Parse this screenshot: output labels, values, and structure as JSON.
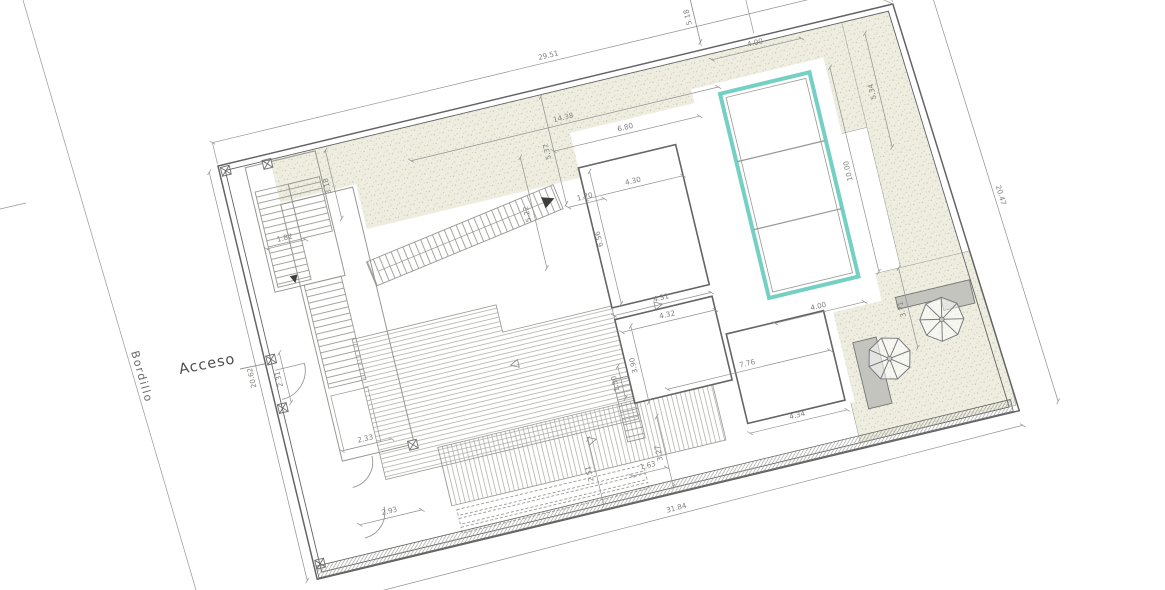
{
  "drawing": {
    "labels": {
      "acceso": "Acceso",
      "bordillo": "Bordillo"
    },
    "colors": {
      "pool": "#74d0c3",
      "garden_fill": "#eeede0",
      "speckle": "#c8c7b1",
      "line": "#979792",
      "wall": "#646464",
      "dim": "#8f8f8f",
      "text": "#81817d",
      "platform": "#c4c4bf"
    },
    "dimensions": [
      {
        "value": "29.51",
        "x1": 0,
        "y1": -24,
        "x2": 694,
        "y2": -24
      },
      {
        "value": "3.58",
        "x1": 552,
        "y1": -46,
        "x2": 634,
        "y2": -46
      },
      {
        "value": "5.34",
        "x1": 660,
        "y1": 22,
        "x2": 660,
        "y2": 139
      },
      {
        "value": "5.18",
        "x1": 498,
        "y1": -62,
        "x2": 498,
        "y2": -8
      },
      {
        "value": "4.00",
        "x1": 505,
        "y1": 12,
        "x2": 597,
        "y2": 12
      },
      {
        "value": "14.38",
        "x1": 189,
        "y1": 40,
        "x2": 505,
        "y2": 40
      },
      {
        "value": "6.80",
        "x1": 330,
        "y1": 64,
        "x2": 480,
        "y2": 64
      },
      {
        "value": "5.37",
        "x1": 330,
        "y1": 8,
        "x2": 330,
        "y2": 118
      },
      {
        "value": "5.22",
        "x1": 296,
        "y1": 62,
        "x2": 296,
        "y2": 176
      },
      {
        "value": "3.18",
        "x1": 108,
        "y1": 10,
        "x2": 108,
        "y2": 80
      },
      {
        "value": "1.82",
        "x1": 28,
        "y1": 92,
        "x2": 68,
        "y2": 92
      },
      {
        "value": "1.70",
        "x1": 331,
        "y1": 122,
        "x2": 368,
        "y2": 122
      },
      {
        "value": "4.30",
        "x1": 350,
        "y1": 118,
        "x2": 450,
        "y2": 118
      },
      {
        "value": "6.56",
        "x1": 360,
        "y1": 92,
        "x2": 360,
        "y2": 228
      },
      {
        "value": "4.31",
        "x1": 350,
        "y1": 238,
        "x2": 450,
        "y2": 238
      },
      {
        "value": "4.32",
        "x1": 354,
        "y1": 256,
        "x2": 450,
        "y2": 256
      },
      {
        "value": "3.90",
        "x1": 364,
        "y1": 252,
        "x2": 364,
        "y2": 330
      },
      {
        "value": "1.50",
        "x1": 342,
        "y1": 288,
        "x2": 342,
        "y2": 321
      },
      {
        "value": "7.76",
        "x1": 385,
        "y1": 322,
        "x2": 552,
        "y2": 322
      },
      {
        "value": "4.34",
        "x1": 455,
        "y1": 384,
        "x2": 555,
        "y2": 384
      },
      {
        "value": "1.63",
        "x1": 330,
        "y1": 398,
        "x2": 366,
        "y2": 398
      },
      {
        "value": "10.00",
        "x1": 618,
        "y1": 47,
        "x2": 618,
        "y2": 257
      },
      {
        "value": "4.00",
        "x1": 505,
        "y1": 283,
        "x2": 597,
        "y2": 283
      },
      {
        "value": "3.71",
        "x1": 638,
        "y1": 258,
        "x2": 638,
        "y2": 340
      },
      {
        "value": "20.47",
        "x1": 734,
        "y1": -2,
        "x2": 762,
        "y2": 425
      },
      {
        "value": "31.84",
        "x1": 10,
        "y1": 452,
        "x2": 722,
        "y2": 440
      },
      {
        "value": "20.62",
        "x1": -10,
        "y1": 4,
        "x2": -10,
        "y2": 424
      },
      {
        "value": "2.31",
        "x1": 16,
        "y1": 196,
        "x2": 16,
        "y2": 247
      },
      {
        "value": "2.33",
        "x1": 54,
        "y1": 306,
        "x2": 105,
        "y2": 306
      },
      {
        "value": "2.93",
        "x1": 54,
        "y1": 382,
        "x2": 118,
        "y2": 382
      },
      {
        "value": "2.51",
        "x1": 296,
        "y1": 352,
        "x2": 296,
        "y2": 420
      },
      {
        "value": "3.27",
        "x1": 368,
        "y1": 346,
        "x2": 368,
        "y2": 418
      }
    ]
  }
}
